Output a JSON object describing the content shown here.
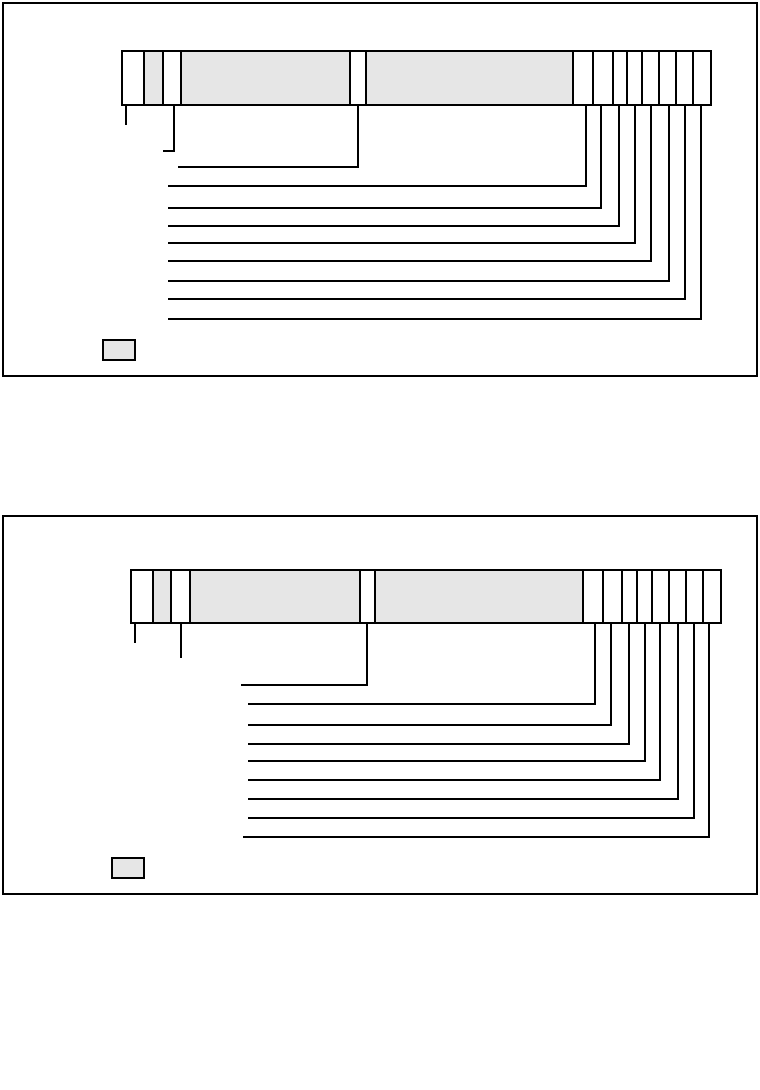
{
  "page": {
    "width": 760,
    "height": 1090,
    "background_color": "#ffffff",
    "line_color": "#000000",
    "shaded_cell_color": "#e6e6e6",
    "line_width": 2
  },
  "diagrams": [
    {
      "name": "type-code-diagram-top",
      "frame": {
        "x1": 2,
        "y1": 2,
        "x2": 758,
        "y2": 377
      },
      "bar": {
        "x1": 121,
        "y1": 50,
        "x2": 712,
        "y2": 106,
        "dividers": [
          143.5,
          162.5,
          180.5,
          350,
          365.5,
          573,
          593,
          612.5,
          627,
          641.5,
          659,
          676,
          693
        ],
        "shaded_spans": [
          [
            143.5,
            162.5
          ],
          [
            180.5,
            350
          ],
          [
            365.5,
            573
          ]
        ]
      },
      "leaders": [
        {
          "x": 125.5,
          "drop_to": 125
        },
        {
          "x": 174,
          "drop_to": 151.5,
          "left_to": 163
        },
        {
          "x": 357.5,
          "drop_to": 168,
          "left_to": 178
        },
        {
          "x": 586,
          "drop_to": 186.5,
          "left_to": 168
        },
        {
          "x": 601,
          "drop_to": 208.5,
          "left_to": 168
        },
        {
          "x": 619,
          "drop_to": 226.5,
          "left_to": 168
        },
        {
          "x": 635,
          "drop_to": 243.5,
          "left_to": 168
        },
        {
          "x": 651,
          "drop_to": 262,
          "left_to": 168
        },
        {
          "x": 668.5,
          "drop_to": 282,
          "left_to": 168
        },
        {
          "x": 684.5,
          "drop_to": 300,
          "left_to": 168
        },
        {
          "x": 700.5,
          "drop_to": 319.5,
          "left_to": 168
        }
      ],
      "legend_swatch": {
        "x1": 102,
        "y1": 339,
        "x2": 136,
        "y2": 361
      }
    },
    {
      "name": "type-code-diagram-bottom",
      "frame": {
        "x1": 2,
        "y1": 515,
        "x2": 758,
        "y2": 895
      },
      "bar": {
        "x1": 130,
        "y1": 569,
        "x2": 722,
        "y2": 624,
        "dividers": [
          152.5,
          171,
          189.5,
          359.5,
          375,
          583,
          602.5,
          621.5,
          637,
          652,
          669,
          686,
          702.5
        ],
        "shaded_spans": [
          [
            152.5,
            171
          ],
          [
            189.5,
            359.5
          ],
          [
            375,
            583
          ]
        ]
      },
      "leaders": [
        {
          "x": 135,
          "drop_to": 643
        },
        {
          "x": 181,
          "drop_to": 657.5
        },
        {
          "x": 367,
          "drop_to": 686,
          "left_to": 241
        },
        {
          "x": 594.5,
          "drop_to": 704.5,
          "left_to": 248
        },
        {
          "x": 610.5,
          "drop_to": 726,
          "left_to": 248
        },
        {
          "x": 628.5,
          "drop_to": 744.5,
          "left_to": 248
        },
        {
          "x": 644.5,
          "drop_to": 761.5,
          "left_to": 248
        },
        {
          "x": 660,
          "drop_to": 781,
          "left_to": 248
        },
        {
          "x": 677.5,
          "drop_to": 800,
          "left_to": 248
        },
        {
          "x": 693.5,
          "drop_to": 819,
          "left_to": 248
        },
        {
          "x": 709,
          "drop_to": 837.5,
          "left_to": 243
        }
      ],
      "legend_swatch": {
        "x1": 111,
        "y1": 857,
        "x2": 145,
        "y2": 879
      }
    }
  ]
}
